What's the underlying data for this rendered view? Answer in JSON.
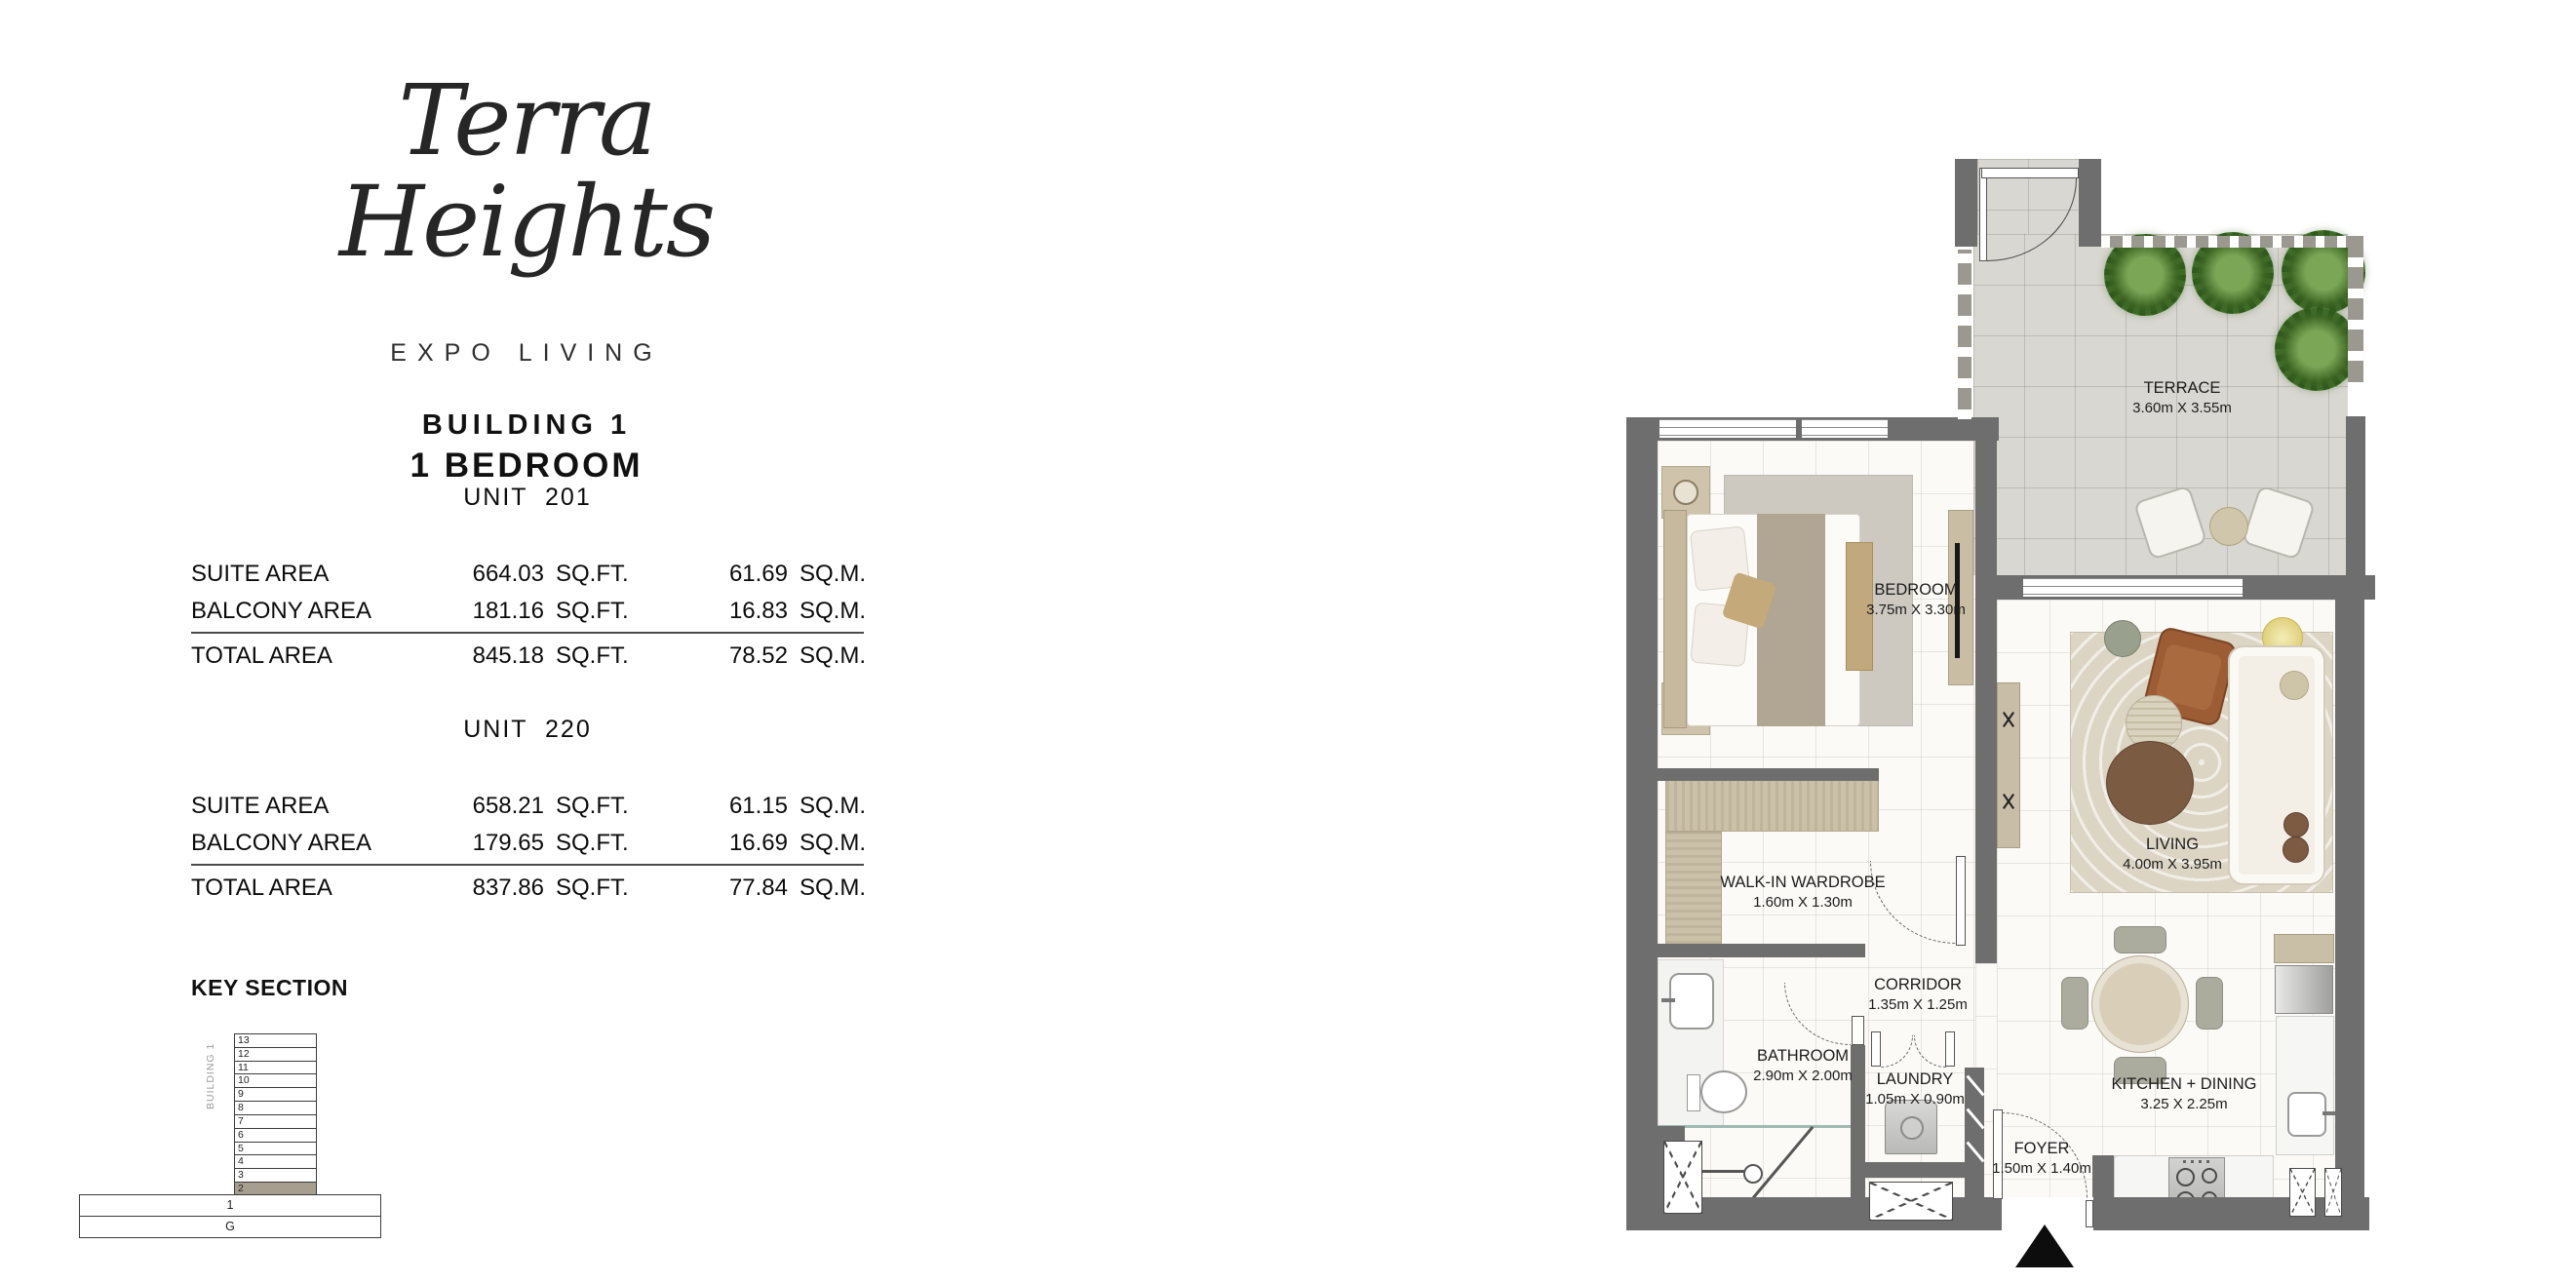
{
  "brand": {
    "name_line1": "Terra",
    "name_line2": "Heights",
    "tagline": "EXPO LIVING"
  },
  "listing": {
    "building": "BUILDING 1",
    "unit_type": "1 BEDROOM"
  },
  "units": [
    {
      "header": "UNIT  201",
      "rows": [
        {
          "label": "SUITE AREA",
          "sqft": "664.03",
          "sqft_unit": "SQ.FT.",
          "sqm": "61.69",
          "sqm_unit": "SQ.M."
        },
        {
          "label": "BALCONY AREA",
          "sqft": "181.16",
          "sqft_unit": "SQ.FT.",
          "sqm": "16.83",
          "sqm_unit": "SQ.M."
        }
      ],
      "total": {
        "label": "TOTAL AREA",
        "sqft": "845.18",
        "sqft_unit": "SQ.FT.",
        "sqm": "78.52",
        "sqm_unit": "SQ.M."
      }
    },
    {
      "header": "UNIT  220",
      "rows": [
        {
          "label": "SUITE AREA",
          "sqft": "658.21",
          "sqft_unit": "SQ.FT.",
          "sqm": "61.15",
          "sqm_unit": "SQ.M."
        },
        {
          "label": "BALCONY AREA",
          "sqft": "179.65",
          "sqft_unit": "SQ.FT.",
          "sqm": "16.69",
          "sqm_unit": "SQ.M."
        }
      ],
      "total": {
        "label": "TOTAL AREA",
        "sqft": "837.86",
        "sqft_unit": "SQ.FT.",
        "sqm": "77.84",
        "sqm_unit": "SQ.M."
      }
    }
  ],
  "key_section": {
    "title": "KEY SECTION",
    "building_label": "BUILDING 1",
    "tower_floors": [
      "13",
      "12",
      "11",
      "10",
      "9",
      "8",
      "7",
      "6",
      "5",
      "4",
      "3",
      "2"
    ],
    "highlighted_floor": "2",
    "podium_floors": [
      "1",
      "G"
    ]
  },
  "floor_plan": {
    "rooms": {
      "terrace": {
        "name": "TERRACE",
        "dims": "3.60m X 3.55m"
      },
      "bedroom": {
        "name": "BEDROOM",
        "dims": "3.75m X 3.30m"
      },
      "living": {
        "name": "LIVING",
        "dims": "4.00m X 3.95m"
      },
      "wardrobe": {
        "name": "WALK-IN WARDROBE",
        "dims": "1.60m X 1.30m"
      },
      "corridor": {
        "name": "CORRIDOR",
        "dims": "1.35m X 1.25m"
      },
      "bathroom": {
        "name": "BATHROOM",
        "dims": "2.90m X 2.00m"
      },
      "laundry": {
        "name": "LAUNDRY",
        "dims": "1.05m X 0.90m"
      },
      "kitchen": {
        "name": "KITCHEN + DINING",
        "dims": "3.25 X 2.25m"
      },
      "foyer": {
        "name": "FOYER",
        "dims": "1.50m X 1.40m"
      }
    },
    "entrance_marker": "north-arrow"
  },
  "colors": {
    "wall": "#6e6e6e",
    "terrace_floor": "#d9d7d1",
    "floor_tile": "#fbfaf7",
    "wood": "#cbc1a9",
    "key_highlight": "#a89e90"
  }
}
